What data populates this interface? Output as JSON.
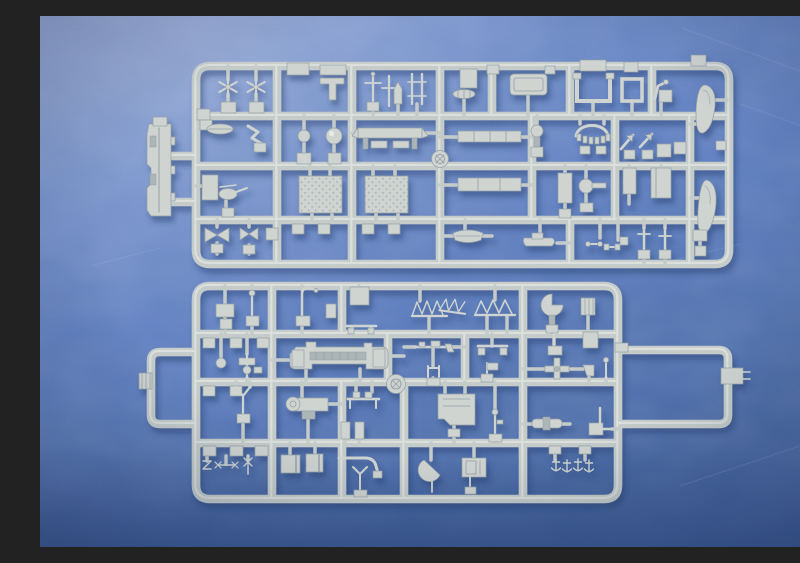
{
  "meta": {
    "description": "Photograph of two light-gray injection-molded polystyrene sprues (model-kit part trees) containing many small ship-model parts, lying diagonally on a mottled blue backdrop.",
    "alt_text": "Two gray plastic model kit sprues with dozens of small parts on a textured blue background",
    "text_content": "none – the image contains no readable text"
  },
  "scene": {
    "colors": {
      "bg_top": "#8398cd",
      "bg_upper": "#6887c7",
      "bg_mid": "#5b7cc0",
      "bg_lower": "#4d6eae",
      "bg_bottom": "#40619f",
      "bg_deep": "#31508c",
      "runner": "#c3cac8",
      "plastic": "#ced3d0",
      "plastic_light": "#e6eae7",
      "plastic_shade": "#aab3b5",
      "plastic_dark": "#929da3",
      "shadow": "#1c3a70"
    },
    "background": {
      "label": "blue mottled paper backdrop",
      "texture": "fine grain with cloudy shading, darker toward bottom"
    },
    "sprues": [
      {
        "id": "top",
        "label": "upper sprue",
        "position": "upper half, spanning left-center to right",
        "approx_part_count": 48,
        "notable_parts": [
          "two six-blade propellers",
          "two tread-textured deck hatches",
          "two airfoil-shaped hull/funnel halves",
          "ship's boats",
          "deck bench",
          "sphere",
          "masts and davits",
          "tall superstructure side piece outside the frame on the left"
        ]
      },
      {
        "id": "bottom",
        "label": "lower sprue",
        "position": "lower half, with an empty runner loop extending right and a small loop on the left",
        "approx_part_count": 46,
        "notable_parts": [
          "bridge superstructure",
          "three zig-zag deck railings",
          "round turntable boss",
          "winch",
          "four tiny anchors",
          "half-disc paravane",
          "gun mounts",
          "funnel cylinders"
        ]
      }
    ]
  }
}
